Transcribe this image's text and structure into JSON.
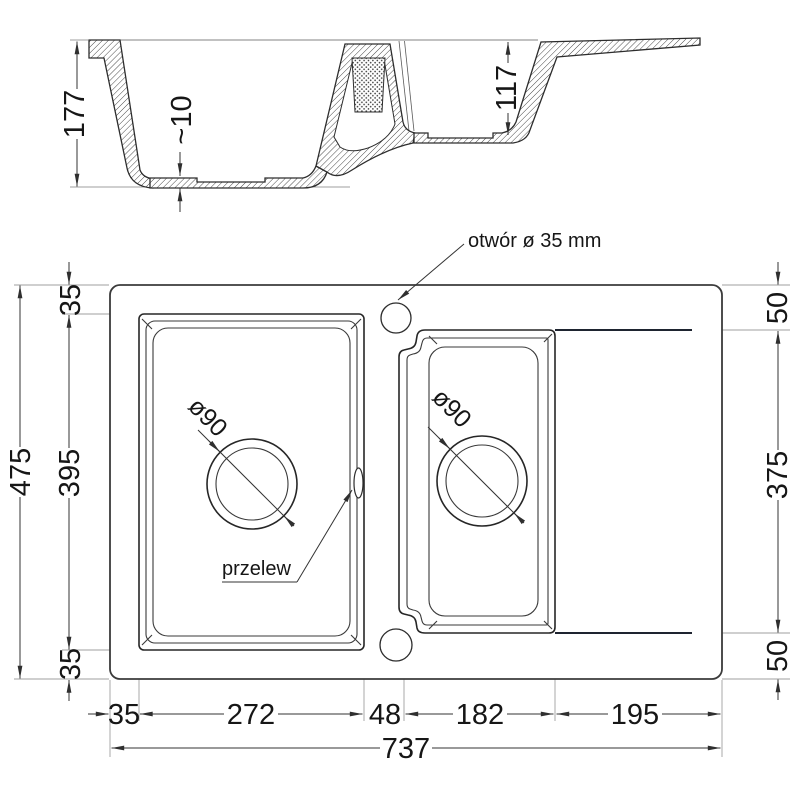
{
  "section_view": {
    "dims": {
      "depth_main": "177",
      "bottom_thickness": "~10",
      "depth_small": "117"
    }
  },
  "plan_view": {
    "dims_left": {
      "total_height": "475",
      "margin_top": "35",
      "bowl_height": "395",
      "margin_bottom": "35"
    },
    "dims_right": {
      "margin_top": "50",
      "inner_height": "375",
      "margin_bottom": "50"
    },
    "dims_bottom": {
      "margin_left": "35",
      "bowl_width": "272",
      "gap": "48",
      "bowl2_width": "182",
      "drainer_width": "195",
      "total_width": "737"
    },
    "labels": {
      "tap_hole": "otwór ø 35 mm",
      "overflow": "przelew",
      "drain_main": "ø90",
      "drain_small": "ø90"
    }
  }
}
